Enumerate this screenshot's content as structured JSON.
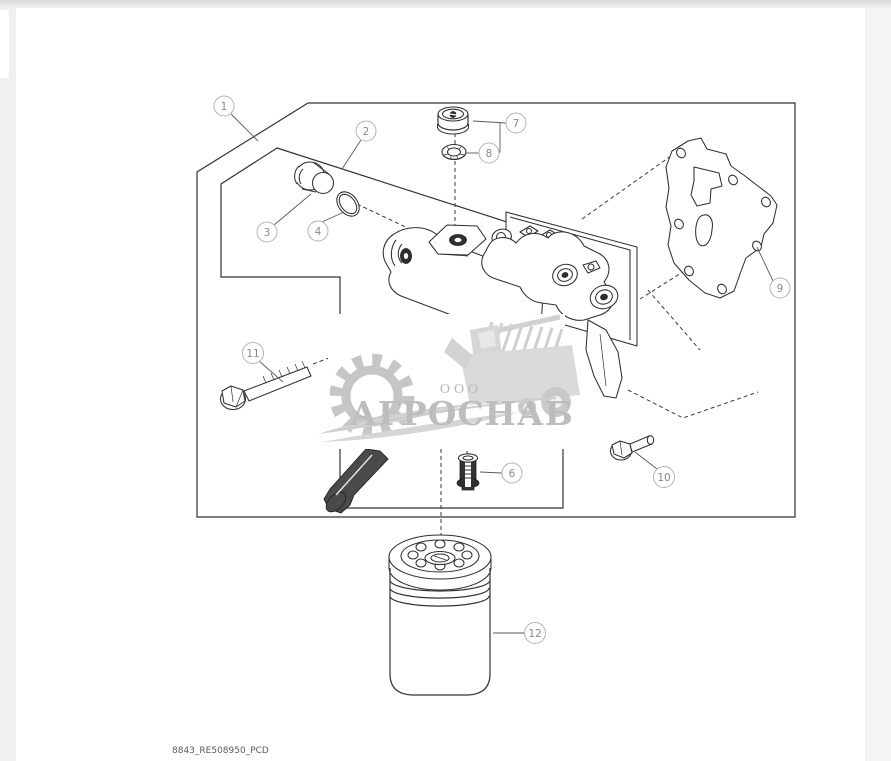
{
  "diagram": {
    "drawing_code": "8843_RE508950_PCD",
    "callouts": [
      {
        "num": "1"
      },
      {
        "num": "2"
      },
      {
        "num": "3"
      },
      {
        "num": "4"
      },
      {
        "num": "6"
      },
      {
        "num": "7"
      },
      {
        "num": "8"
      },
      {
        "num": "9"
      },
      {
        "num": "10"
      },
      {
        "num": "11"
      },
      {
        "num": "12"
      }
    ]
  },
  "watermark": {
    "prefix": "ООО",
    "name": "АГРОСНАБ"
  },
  "colors": {
    "line": "#333333",
    "callout_ring": "#b3b3b3",
    "watermark_grey": "#c6c6c6",
    "page": "#ffffff",
    "margin": "#f0f0f0"
  }
}
